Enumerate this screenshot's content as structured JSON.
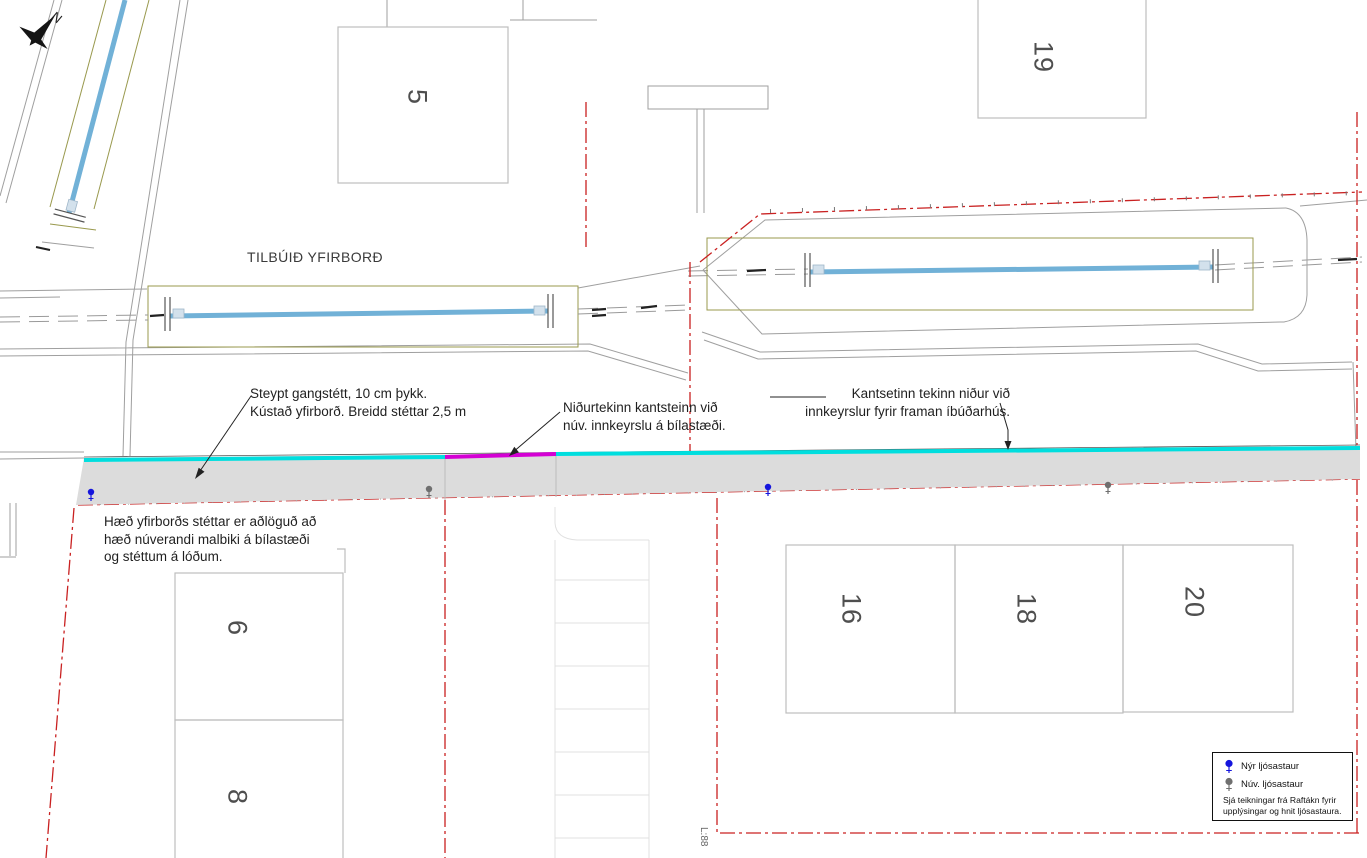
{
  "compass": {
    "label": "N"
  },
  "surface_label": "TILBÚIÐ YFIRBORÐ",
  "annotations": {
    "sidewalk": {
      "line1": "Steypt gangstétt, 10 cm þykk.",
      "line2": "Kústað yfirborð. Breidd stéttar 2,5 m"
    },
    "curb_driveway": {
      "line1": "Niðurtekinn kantsteinn við",
      "line2": "núv. innkeyrslu á bílastæði."
    },
    "curb_houses": {
      "line1": "Kantsetinn tekinn niður við",
      "line2": "innkeyrslur fyrir framan íbúðarhús."
    },
    "surface_height": {
      "line1": "Hæð yfirborðs stéttar er aðlöguð að",
      "line2": "hæð núverandi malbiki á bílastæði",
      "line3": "og stéttum á lóðum."
    }
  },
  "houses": {
    "h5": "5",
    "h19": "19",
    "h6": "6",
    "h8": "8",
    "h16": "16",
    "h18": "18",
    "h20": "20"
  },
  "legend": {
    "new_lamp": "Nýr ljósastaur",
    "existing_lamp": "Núv. ljósastaur",
    "note1": "Sjá teikningar frá Raftákn fyrir",
    "note2": "upplýsingar og hnit ljósastaura."
  },
  "station_label": "L:88",
  "colors": {
    "new_curb_cyan": "#00dede",
    "lowered_curb_magenta": "#d400d4",
    "heating_pipe_blue": "#71b1d7",
    "boundary_red": "#c92121",
    "trench_outline_olive": "#99994d",
    "sidewalk_fill_gray": "#dcdcdc",
    "new_lamp_blue": "#1515dd",
    "existing_lamp_gray": "#6f6f6f"
  }
}
